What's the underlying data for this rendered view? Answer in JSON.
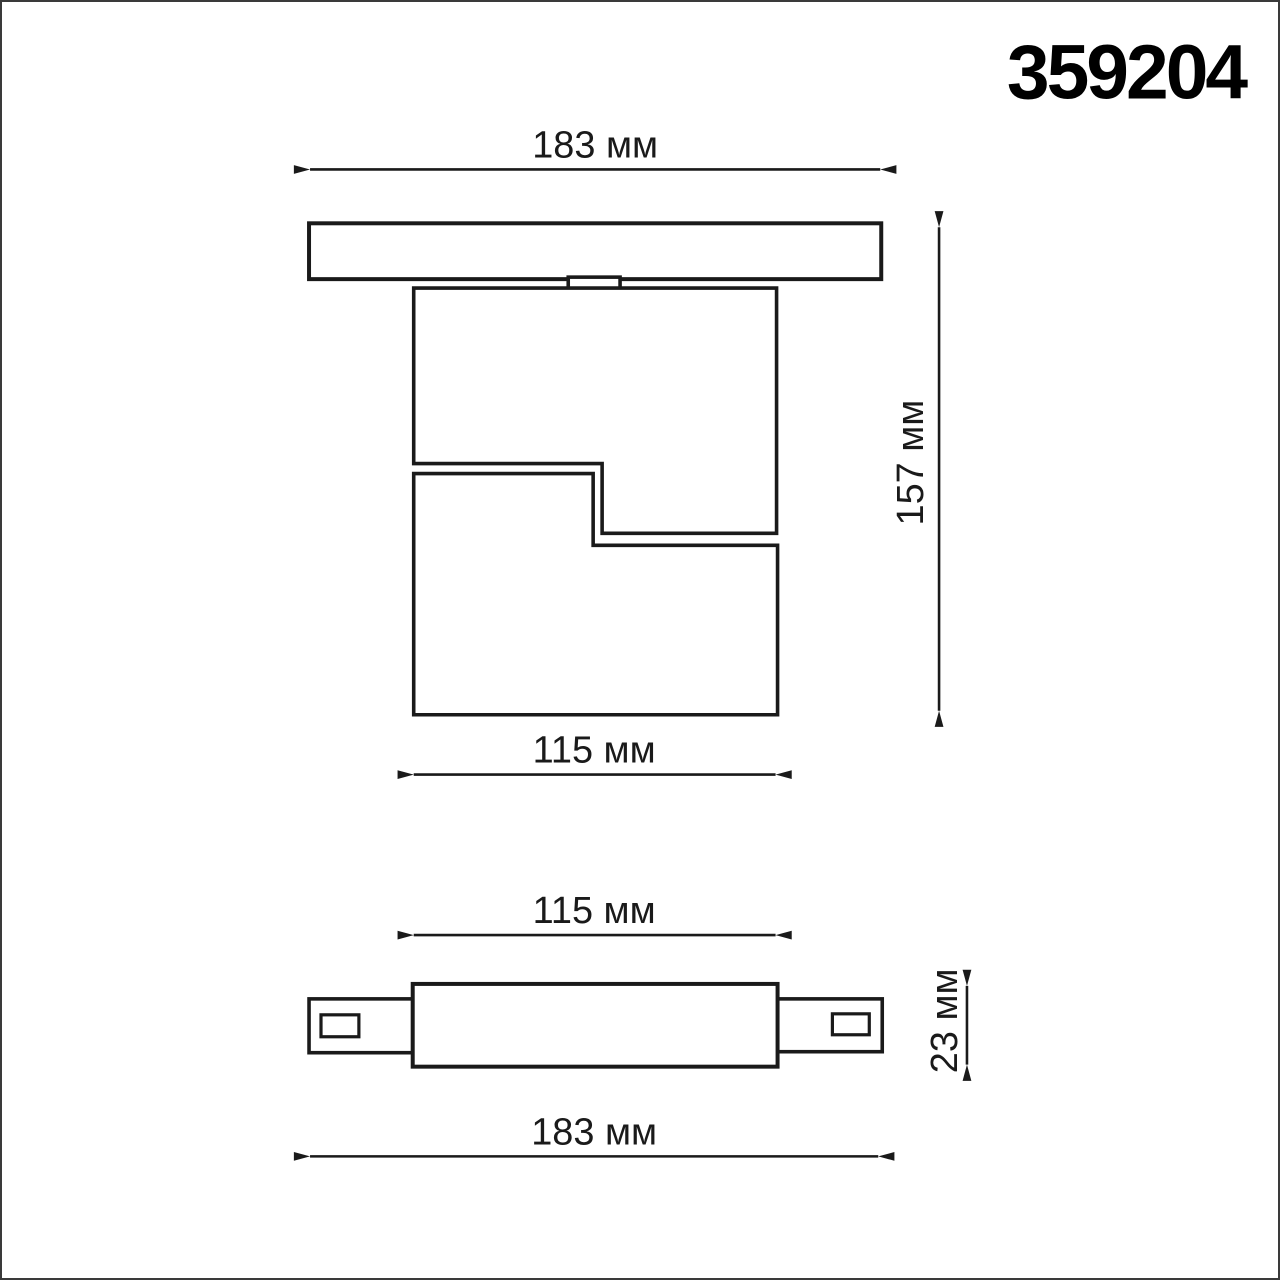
{
  "title": "359204",
  "unit": "мм",
  "colors": {
    "line": "#1a1a1a",
    "background": "#ffffff",
    "page_border": "#3a3a3a"
  },
  "front_view": {
    "name": "front view — track with swivel lamp head",
    "dimensions": {
      "track_width": {
        "label": "183 мм",
        "value_mm": 183,
        "orientation": "horizontal"
      },
      "total_height": {
        "label": "157 мм",
        "value_mm": 157,
        "orientation": "vertical"
      },
      "body_width": {
        "label": "115 мм",
        "value_mm": 115,
        "orientation": "horizontal"
      }
    }
  },
  "side_view": {
    "name": "side view — track connector with end tabs",
    "dimensions": {
      "body_width": {
        "label": "115 мм",
        "value_mm": 115,
        "orientation": "horizontal"
      },
      "track_height": {
        "label": "23 мм",
        "value_mm": 23,
        "orientation": "vertical"
      },
      "track_width": {
        "label": "183 мм",
        "value_mm": 183,
        "orientation": "horizontal"
      }
    }
  }
}
